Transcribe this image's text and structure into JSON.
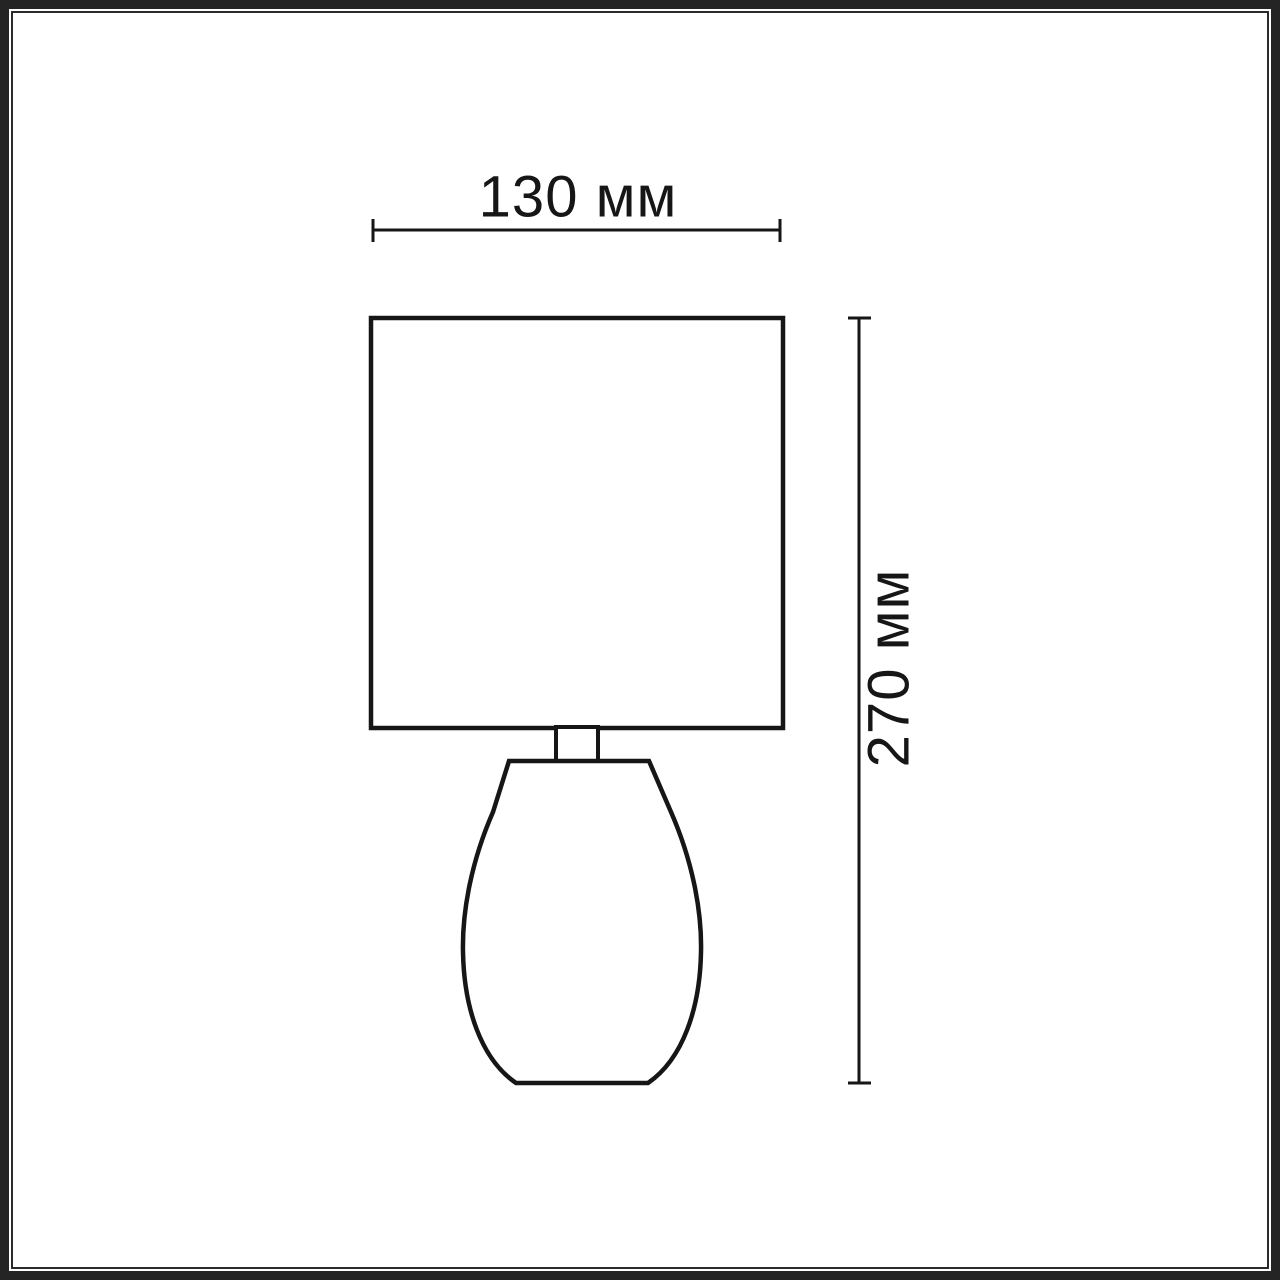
{
  "frame": {
    "outer_color": "#242424",
    "inner_color": "#2b2b2b",
    "background": "#ffffff"
  },
  "drawing": {
    "line_color": "#161616",
    "dimensions": {
      "width": {
        "label": "130 мм",
        "value": 130,
        "unit": "мм"
      },
      "height": {
        "label": "270 мм",
        "value": 270,
        "unit": "мм"
      }
    }
  }
}
